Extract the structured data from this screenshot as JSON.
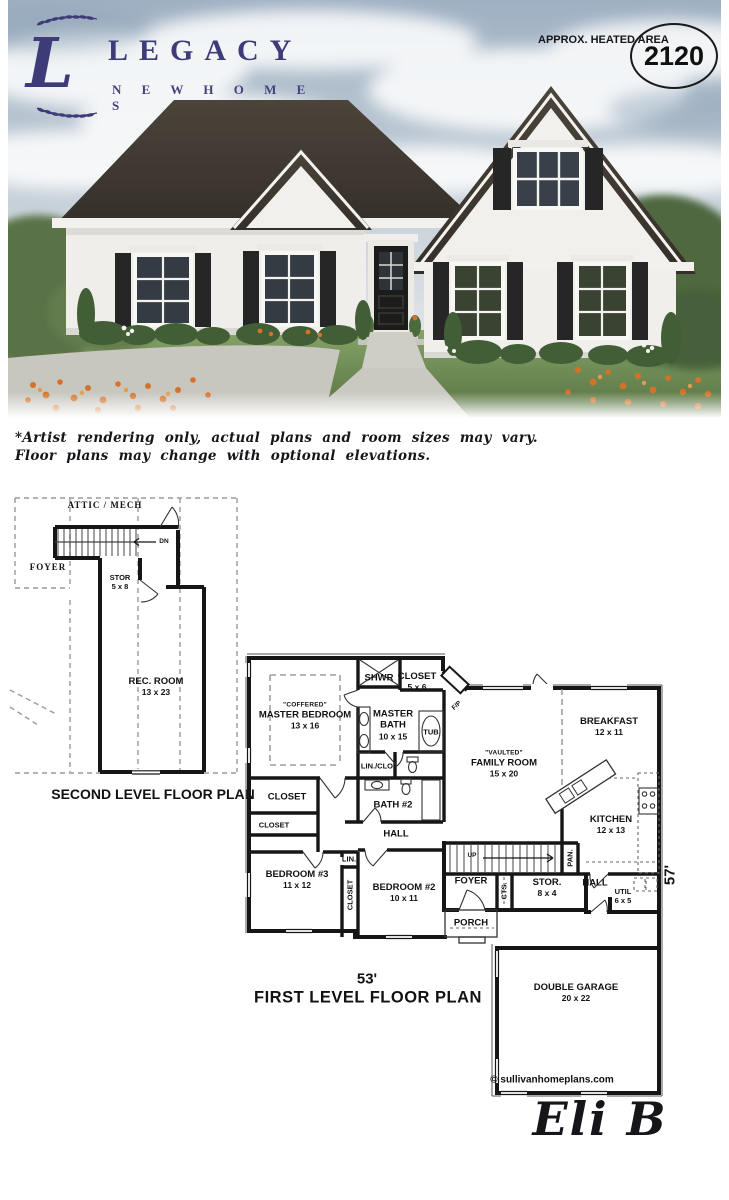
{
  "logo": {
    "monogram": "L",
    "brand": "LEGACY",
    "subbrand": "N E W   H O M E S"
  },
  "badge": {
    "label": "APPROX. HEATED AREA",
    "value": "2120"
  },
  "disclaimer": {
    "line1": "*Artist rendering only, actual plans and room sizes may vary.",
    "line2": "Floor plans may change with optional elevations."
  },
  "second_floor": {
    "caption": "SECOND LEVEL FLOOR PLAN",
    "attic": "ATTIC / MECH",
    "foyer": "FOYER",
    "dn": "DN",
    "stor": {
      "name": "STOR",
      "dims": "5 x 8"
    },
    "rec_room": {
      "name": "REC. ROOM",
      "dims": "13 x 23"
    }
  },
  "first_floor": {
    "caption": "FIRST LEVEL FLOOR PLAN",
    "width_dim": "53'",
    "depth_dim": "57'",
    "copyright": "© sullivanhomeplans.com",
    "master_bedroom": {
      "note": "\"COFFERED\"",
      "name": "MASTER BEDROOM",
      "dims": "13 x 16"
    },
    "shwr": "SHWR",
    "closet1": {
      "name": "CLOSET",
      "dims": "5 x 6"
    },
    "master_bath": {
      "name": "MASTER BATH",
      "dims": "10 x 15"
    },
    "tub": "TUB",
    "fp": "F/P",
    "breakfast": {
      "name": "BREAKFAST",
      "dims": "12 x 11"
    },
    "family_room": {
      "note": "\"VAULTED\"",
      "name": "FAMILY ROOM",
      "dims": "15 x 20"
    },
    "lin_clo": "LIN./CLO.",
    "bath2": "BATH #2",
    "closet2": "CLOSET",
    "closet3": "CLOSET",
    "hall1": "HALL",
    "kitchen": {
      "name": "KITCHEN",
      "dims": "12 x 13"
    },
    "up": "UP",
    "pan": "PAN.",
    "bedroom3": {
      "name": "BEDROOM #3",
      "dims": "11 x 12"
    },
    "lin": "LIN.",
    "closet4": "CLOSET",
    "bedroom2": {
      "name": "BEDROOM #2",
      "dims": "10 x 11"
    },
    "foyer": "FOYER",
    "cts": "CTS.",
    "stor": {
      "name": "STOR.",
      "dims": "8 x 4"
    },
    "hall2": "HALL",
    "util": {
      "name": "UTIL",
      "dims": "6 x 5"
    },
    "porch": "PORCH",
    "garage": {
      "name": "DOUBLE GARAGE",
      "dims": "20 x 22"
    }
  },
  "plate": "Eli B",
  "colors": {
    "brand_navy": "#3e3c78",
    "plan_ink": "#161616",
    "roof": "#443e37",
    "lawn": "#6d8b54"
  }
}
